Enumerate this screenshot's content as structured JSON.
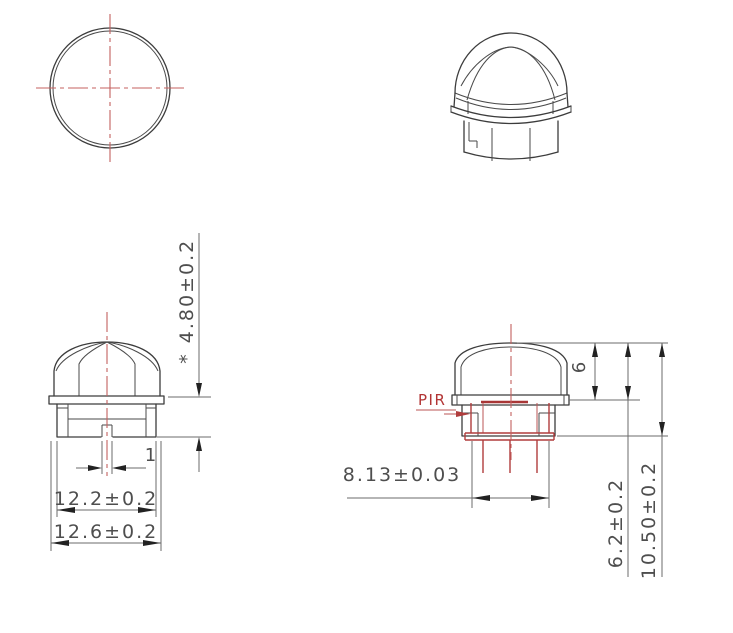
{
  "drawing": {
    "type": "engineering-cad-drawing",
    "part": "dome lens cap over PIR sensor",
    "colors": {
      "background": "#ffffff",
      "object_line": "#3c3c3c",
      "dimension_line": "#6b6b6b",
      "dimension_text": "#4e4e4e",
      "red_accent": "#b03d3d",
      "centerline_red": "#c4605f"
    },
    "dims": {
      "front": {
        "height_prefix": "*",
        "height": "4.80±0.2",
        "slot_width": "1",
        "body_width": "12.2±0.2",
        "flange_width": "12.6±0.2"
      },
      "side": {
        "label": "PIR",
        "dome_height": "6",
        "sensor_diameter": "8.13±0.03",
        "height_to_flange": "6.2±0.2",
        "total_height": "10.50±0.2"
      }
    }
  }
}
